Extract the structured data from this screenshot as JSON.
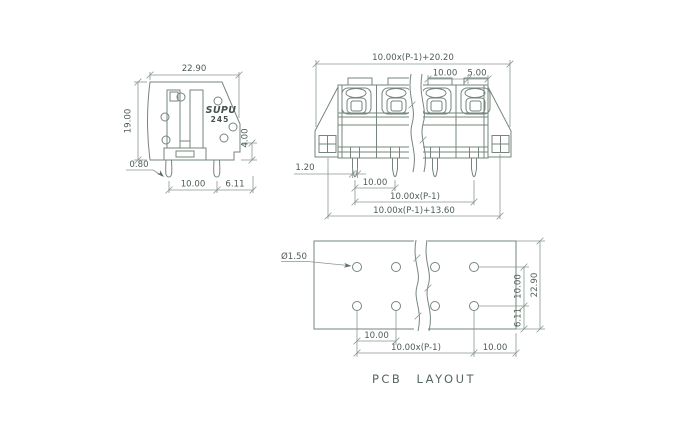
{
  "caption": "PCB LAYOUT",
  "side_view": {
    "logo": "SUPU",
    "model": "245",
    "dim_width": "22.90",
    "dim_height": "19.00",
    "dim_pin_thickness": "0.80",
    "dim_pin_pitch": "10.00",
    "dim_pin_edge": "6.11",
    "dim_standoff": "4.00"
  },
  "front_view": {
    "dim_overall_width": "10.00x(P-1)+20.20",
    "dim_pole_pitch": "10.00",
    "dim_end_margin": "5.00",
    "dim_pin_width": "1.20",
    "dim_pin_pitch": "10.00",
    "dim_pin_span": "10.00x(P-1)",
    "dim_mount_span": "10.00x(P-1)+13.60"
  },
  "pcb_layout": {
    "dim_hole_diameter": "Ø1.50",
    "dim_row_spacing": "10.00",
    "dim_board_height": "22.90",
    "dim_bottom_edge": "6.11",
    "dim_hole_pitch": "10.00",
    "dim_hole_span": "10.00x(P-1)",
    "dim_right_edge": "10.00"
  },
  "colors": {
    "line": "#76857e",
    "text": "#4e5d56",
    "logo": "#44534c",
    "background": "#ffffff"
  }
}
